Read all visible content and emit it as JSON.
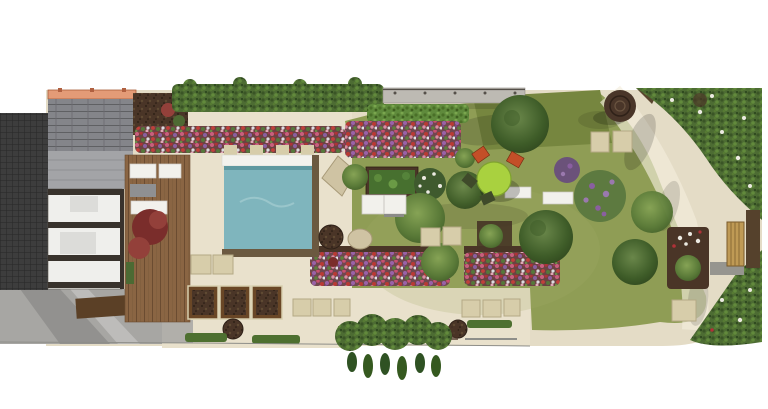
{
  "scene": {
    "type": "landscape-garden-design-plan",
    "view": "top-down-render",
    "canvas": {
      "width": 768,
      "height": 409
    }
  },
  "features": [
    "neighboring-roof",
    "house-with-glass-roof",
    "orange-boundary-wall",
    "timber-deck",
    "deck-loungers",
    "red-maple-shrub",
    "swimming-pool",
    "pool-terrace",
    "pergola-posts",
    "top-hedge",
    "boundary-fence",
    "mixed-flower-borders",
    "main-lawn",
    "vegetable-bed",
    "shrub-beds",
    "round-dining-table-set",
    "sun-loungers",
    "stepping-stones",
    "corten-planters",
    "clipped-low-hedges",
    "curved-gravel-path",
    "tree-stump-feature",
    "garden-bench",
    "corner-shrub-masses",
    "driveway-paving",
    "boulders",
    "planting-pots"
  ],
  "colors": {
    "background": "#ffffff",
    "patio": "#e4dcc6",
    "patio_light": "#e9e1cc",
    "lawn": "#8f9d55",
    "lawn_dark": "#76863f",
    "lawn_highlight": "#a3ae6a",
    "pool_water": "#7fb5bd",
    "pool_ripple": "#9ac6cb",
    "pool_rim": "#6b5940",
    "pool_band": "#f3f2ed",
    "soil": "#4a3527",
    "hedge_low": "#4e7030",
    "roof_light": "#a3a4a7",
    "wall_orange": "#e39b77",
    "rooms": "#efefec",
    "beam": "#38322c",
    "furniture": "#dcdcd9",
    "driveway": "#a7a6a3",
    "stone": "#d7cdaa",
    "planter": "#6a4726",
    "planter_rim": "#d8cfae",
    "table_green": "#a9d13f",
    "chair_orange": "#c34f28",
    "chair_dark": "#3f4a2a",
    "lounger": "#f2f1ec",
    "boulder": "#cfc3a3",
    "bench": "#bf9a55",
    "gray_wall": "#96958f",
    "stump": "#4a3629",
    "red_maple": "#7a2d2b",
    "red_maple2": "#93403a",
    "veg_green": "#47702f",
    "shrub_dark": "#3f5a2e",
    "fence": "#bdbab3",
    "path_light": "#f2ecdc",
    "line": "#8e8e89",
    "shadow": "#000000",
    "bloom_white": "#eceae2",
    "bloom_purple": "#8a5fa0",
    "bloom_purple2": "#9a79ae",
    "bloom_red": "#b03238",
    "tree_blotch": "#3e5c28",
    "wood_brown": "#5b4026"
  }
}
